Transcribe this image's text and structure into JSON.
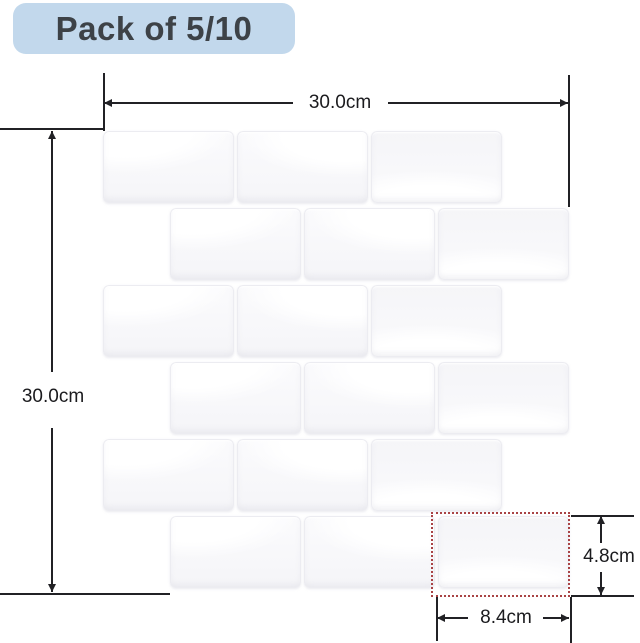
{
  "badge": {
    "label": "Pack of 5/10"
  },
  "dimensions": {
    "sheet_width_label": "30.0cm",
    "sheet_height_label": "30.0cm",
    "tile_width_label": "8.4cm",
    "tile_height_label": "4.8cm"
  },
  "colors": {
    "badge_bg": "#c2d8ec",
    "badge_text": "#3d4247",
    "dimension_line": "#212125",
    "highlight_red": "#a94345",
    "tile_edge": "#ececf1",
    "tile_face": "#f5f5f8"
  },
  "sheet": {
    "pattern": "running-bond-subway-tiles",
    "rows": 6,
    "tiles_per_row": 3,
    "origin_x": 103,
    "origin_y": 131,
    "tile_w": 131,
    "tile_h": 72,
    "gap_x": 3,
    "gap_y": 5,
    "even_row_offset": 67,
    "highlighted_tile": {
      "row": 6,
      "col": 3
    }
  }
}
